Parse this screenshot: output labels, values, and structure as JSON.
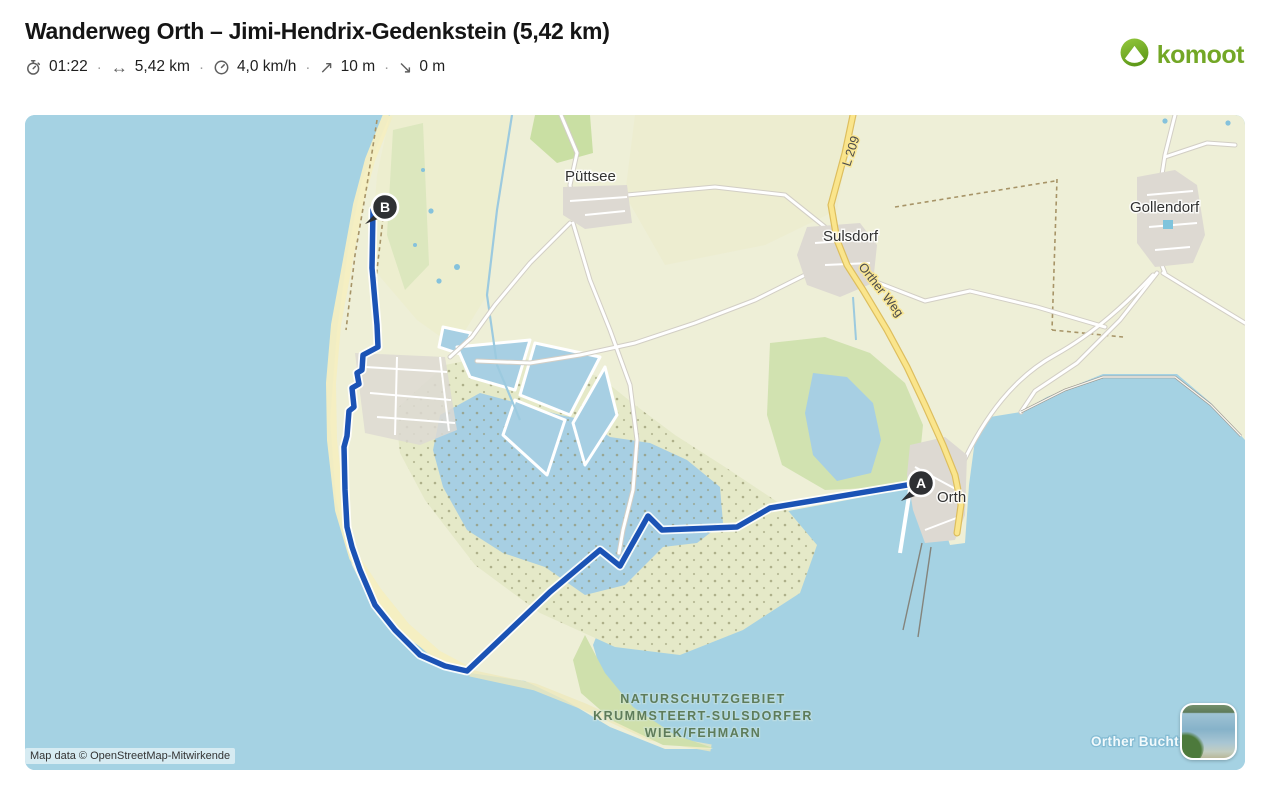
{
  "header": {
    "title": "Wanderweg Orth – Jimi-Hendrix-Gedenkstein (5,42 km)",
    "separator": "·",
    "stats": [
      {
        "name": "duration",
        "icon": "stopwatch-icon",
        "glyph": "",
        "value": "01:22"
      },
      {
        "name": "distance",
        "icon": "distance-icon",
        "glyph": "↔",
        "value": "5,42 km"
      },
      {
        "name": "avg-speed",
        "icon": "speedometer-icon",
        "glyph": "",
        "value": "4,0 km/h"
      },
      {
        "name": "ascent",
        "icon": "ascent-icon",
        "glyph": "↗",
        "value": "10 m"
      },
      {
        "name": "descent",
        "icon": "descent-icon",
        "glyph": "↘",
        "value": "0 m"
      }
    ]
  },
  "brand": {
    "name": "komoot",
    "green": "#73a726"
  },
  "map": {
    "attribution": "Map data © OpenStreetMap-Mitwirkende",
    "labels": {
      "puettsee": "Püttsee",
      "sulsdorf": "Sulsdorf",
      "gollendorf": "Gollendorf",
      "orth": "Orth",
      "road_l209": "L 209",
      "road_orther_weg": "Orther Weg",
      "nature_reserve_line1": "NATURSCHUTZGEBIET",
      "nature_reserve_line2": "KRUMMSTEERT-SULSDORFER",
      "nature_reserve_line3": "WIEK/FEHMARN",
      "water": "Orther Bucht"
    },
    "route": {
      "color": "#1b53b5",
      "points": "348,95 347,153 352,210 353,232 338,240 337,255 332,258 334,269 327,273 329,292 324,296 322,321 319,332 320,375 322,412 327,432 335,455 350,490 370,515 395,540 420,551 442,556 525,477 575,435 595,451 623,401 637,415 712,412 745,393 888,369"
    },
    "markers": {
      "start": "A",
      "end": "B"
    },
    "colors": {
      "water": "#a5d2e3",
      "land": "#eeefd7",
      "beach": "#f4eec1",
      "town": "#ddd9d2",
      "forest": "#c9dfa3",
      "lake": "#a7cfe3",
      "road_yellow": "#fae58c",
      "marker": "#2e3033"
    }
  }
}
